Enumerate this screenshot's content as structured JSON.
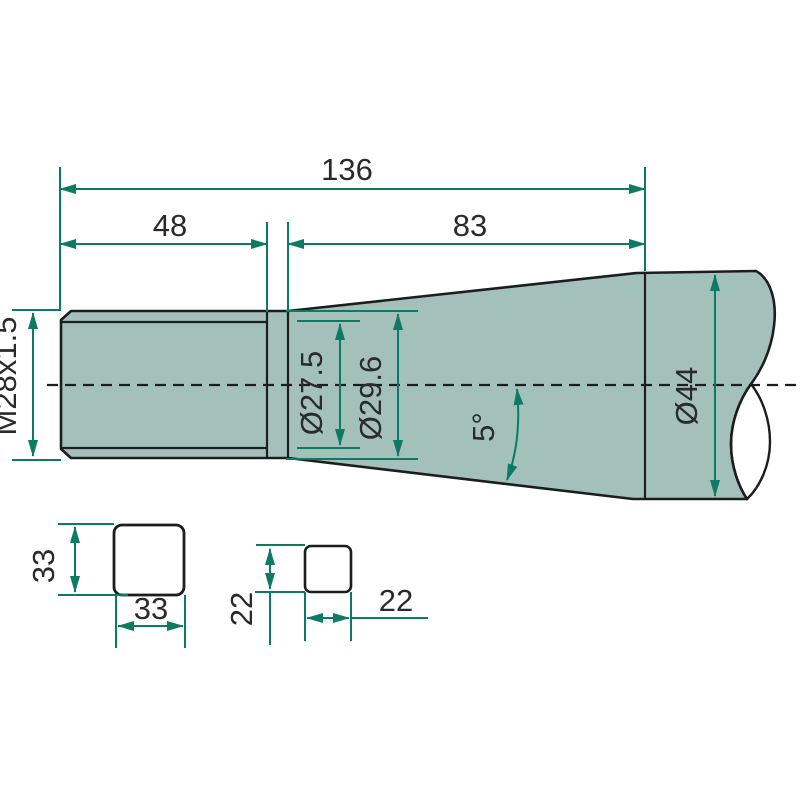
{
  "meta": {
    "type": "technical-drawing",
    "description": "Dimensioned engineering side view of a conical tine with threaded end, broken-out round section at right, and two hatched square cross-sections below"
  },
  "colors": {
    "dimension": "#0d7a64",
    "outline": "#1c1e1d",
    "part_fill": "#a4c0bb",
    "section_fill": "#d9e0dd",
    "ink": "#2a2a2a",
    "background": "#ffffff"
  },
  "dimensions": {
    "total_length": "136",
    "thread_length": "48",
    "cone_length": "83",
    "thread_spec": "M28x1.5",
    "root_diameter": "Ø27.5",
    "neck_diameter": "Ø29.6",
    "cone_angle": "5°",
    "max_diameter": "Ø44",
    "square_large_height": "33",
    "square_large_width": "33",
    "square_small_height": "22",
    "square_small_width": "22"
  }
}
